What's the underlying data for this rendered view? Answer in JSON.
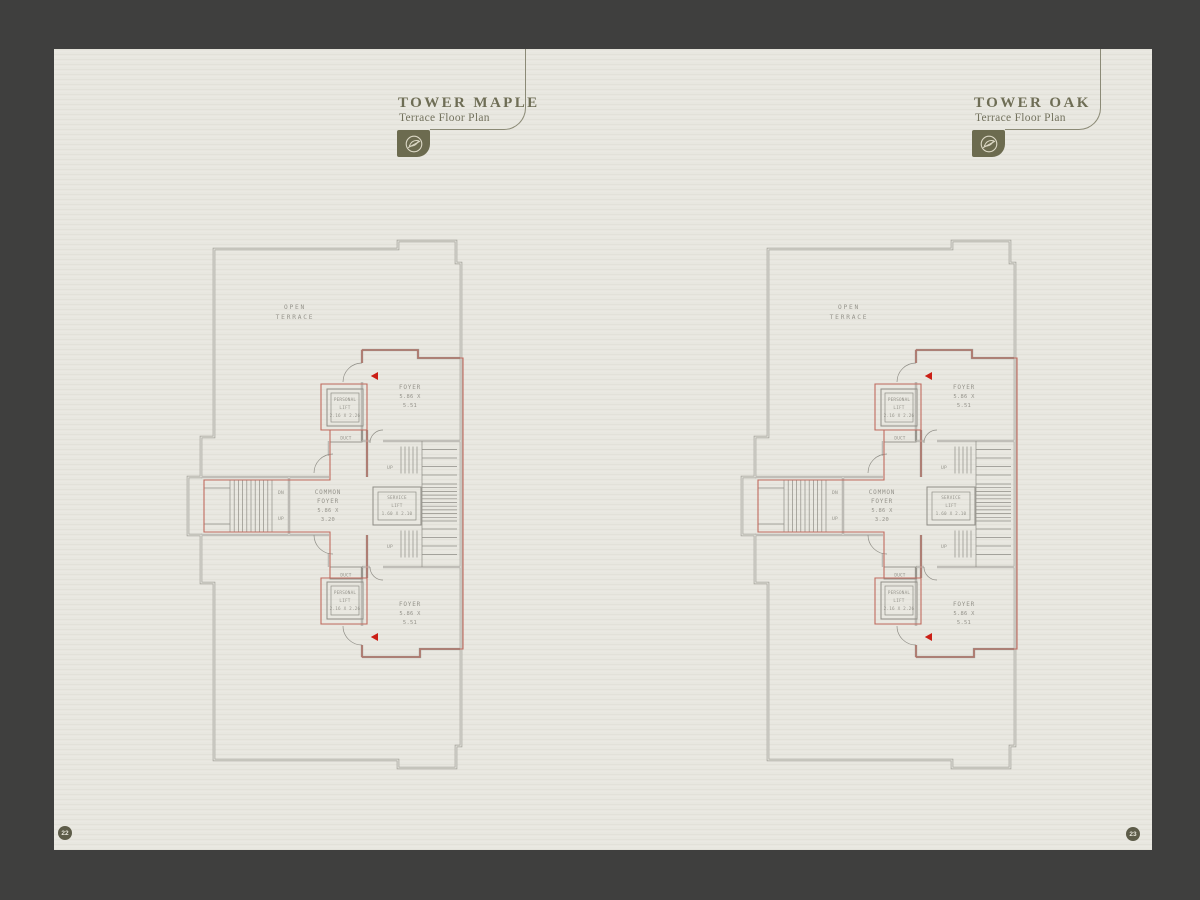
{
  "colors": {
    "frame": "#3f3f3e",
    "page": "#e8e7e0",
    "olive": "#6c6b4f",
    "header_text": "#6e6d55",
    "plan_line_gray": "#a2a099",
    "plan_label_gray": "#95938b",
    "unit_boundary_red": "#c06a5e",
    "entry_arrow_red": "#cb1f16"
  },
  "left_page": {
    "title": "TOWER MAPLE",
    "subtitle": "Terrace Floor Plan",
    "page_number": "22"
  },
  "right_page": {
    "title": "TOWER OAK",
    "subtitle": "Terrace Floor Plan",
    "page_number": "23"
  },
  "plan_labels": {
    "open_terrace_1": "OPEN",
    "open_terrace_2": "TERRACE",
    "foyer": "FOYER",
    "foyer_dim_1": "5.86 X",
    "foyer_dim_2": "5.51",
    "common_1": "COMMON",
    "common_2": "FOYER",
    "common_dim_1": "5.86 X",
    "common_dim_2": "3.20",
    "service_1": "SERVICE",
    "service_2": "LIFT",
    "service_dim": "1.60 X 2.10",
    "personal_1": "PERSONAL",
    "personal_2": "LIFT",
    "personal_dim": "2.16 X 2.26",
    "duct": "DUCT",
    "up": "UP",
    "dn": "DN"
  }
}
